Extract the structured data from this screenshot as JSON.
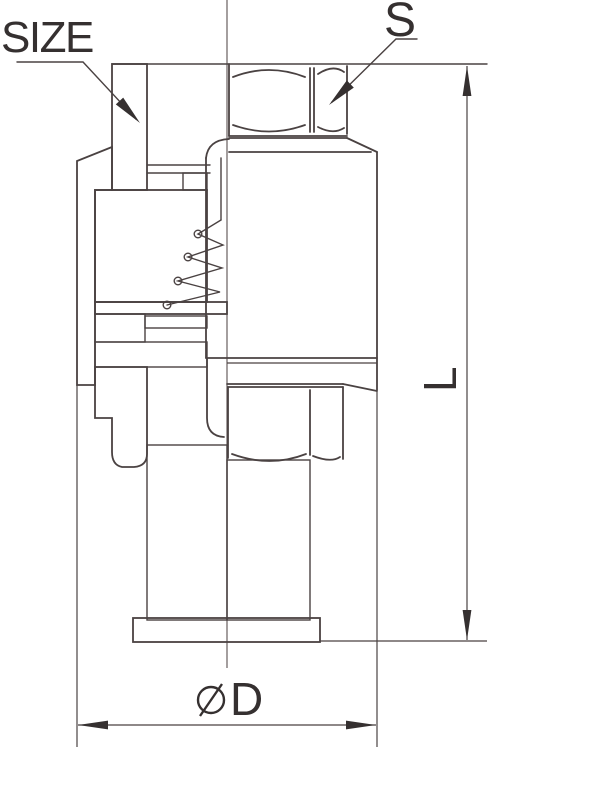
{
  "drawing": {
    "kind": "valve cross-section technical drawing",
    "background": "#ffffff",
    "stroke_color": "#4a4242",
    "text_color": "#353030"
  },
  "annotations": {
    "size_label": "SIZE",
    "s_label": "S"
  },
  "dimensions": {
    "length": {
      "label": "L",
      "orientation": "vertical"
    },
    "diameter": {
      "label": "D",
      "symbol": "diameter",
      "orientation": "horizontal"
    }
  }
}
